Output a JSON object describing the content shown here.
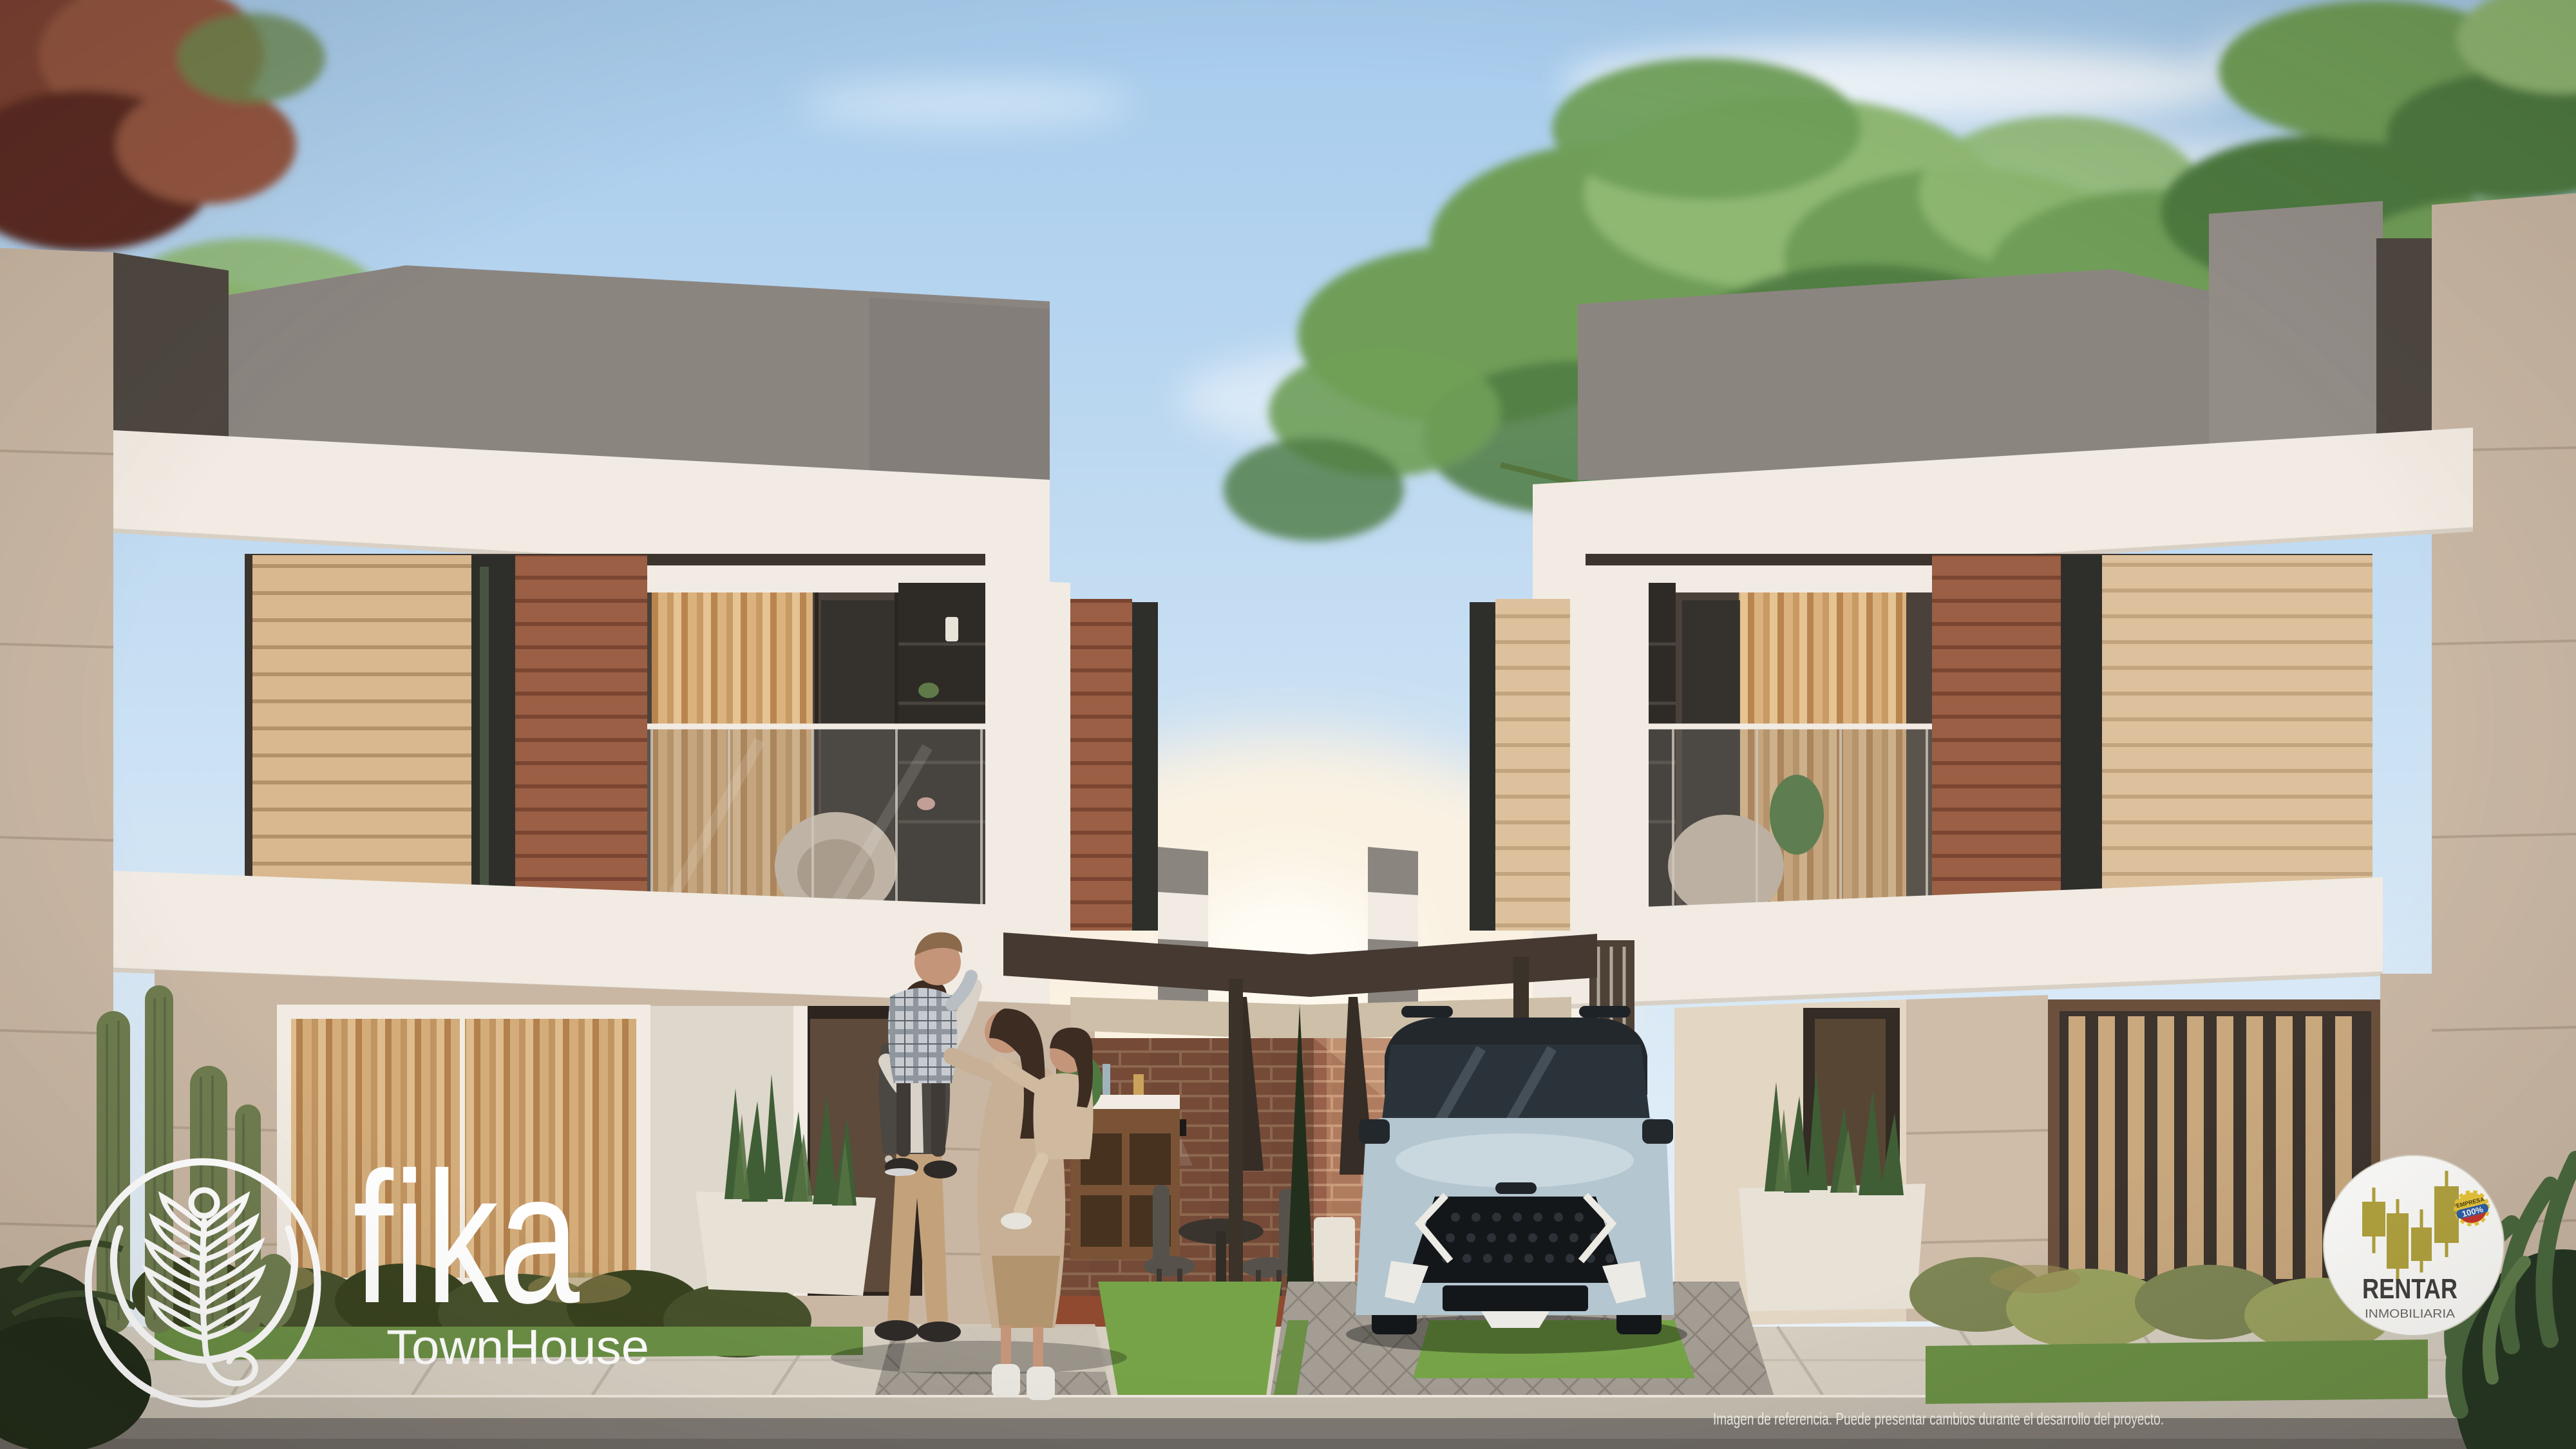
{
  "branding": {
    "fika": {
      "wordmark": "fika",
      "tagline": "TownHouse"
    },
    "rentar": {
      "wordmark": "RENTAR",
      "subtitle": "INMOBILIARIA",
      "badge_top": "EMPRESA",
      "badge_value": "100%"
    }
  },
  "footer": {
    "disclaimer": "Imagen de referencia. Puede presentar cambios durante el desarrollo del proyecto."
  },
  "colors": {
    "sky_top": "#a6cbec",
    "sky_mid": "#cde2f4",
    "sky_horizon": "#eef5fa",
    "sun_glow": "#fff3e0",
    "cloud": "#ffffff",
    "fol_red": "#7c4130",
    "fol_red2": "#93543f",
    "fol_red_dark": "#5a2c20",
    "fol_green": "#6f9e58",
    "fol_green_dark": "#4e7a41",
    "fol_green_light": "#8fb873",
    "concrete": "#8b8580",
    "concrete_dark": "#4e4741",
    "concrete_light": "#938d88",
    "band_white": "#f1ebe3",
    "band_shadow": "#d8d0c4",
    "stone": "#c9b7a4",
    "stone_seam": "#ac9a86",
    "stone_light": "#cfbdaa",
    "wood_light": "#d9b78f",
    "wood_light_gap": "#b5916a",
    "wood_dark": "#9a5f44",
    "wood_dark_gap": "#7a4531",
    "wood_pale": "#ddc19c",
    "wood_pale_gap": "#c2a47e",
    "glass_dark": "#2e2f2b",
    "interior_dark": "#3c342d",
    "interior_mid": "#4a423a",
    "curt1": "#b9854f",
    "curt2": "#dbb27e",
    "curt3": "#c89a64",
    "curt4": "#e6c392",
    "brick": "#96604a",
    "brick2": "#8f5a45",
    "brick_mortar": "#b98a6e",
    "pergola_dark": "#453931",
    "soffit": "#cdbfa8",
    "grass": "#6a8f45",
    "grass_bright": "#76a348",
    "bush_dark": "#38421f",
    "bush_mid": "#46512c",
    "bush_olive": "#7d8554",
    "bush_olive2": "#99a15f",
    "bush_gold": "#9a8d55",
    "cactus": "#6e7c4f",
    "cactus_dark": "#596745",
    "paver": "#a39d94",
    "paver_joint": "#8a847b",
    "patio_floor": "#8f4a30",
    "sidewalk": "#d6cfc2",
    "sidewalk_joint": "#b7b0a3",
    "curb": "#c3bcaf",
    "street": "#7d7872",
    "street_dark": "#6b6762",
    "car_body": "#b4c6d0",
    "car_body_light": "#cddbe2",
    "car_dark": "#23282d",
    "car_glass": "#2b333a",
    "car_trim": "#eceae4",
    "car_black": "#14171a",
    "skin": "#c59579",
    "hair_dark": "#3c2c22",
    "hair_brown": "#8a6a4a",
    "vest": "#4b4743",
    "shirt_light": "#d8d2c8",
    "pants_tan": "#c3a27b",
    "shoe_dark": "#2e2a28",
    "coat_beige": "#c7b095",
    "skirt_tan": "#b2946f",
    "boots_white": "#e9e6df",
    "plaid_base": "#c7cbd0",
    "plaid_line": "#8f969e",
    "wall_sunlit": "#e3d6c3",
    "door_wood": "#5d4a3a",
    "planter_white": "#e8e1d6",
    "logo_white": "#ffffff",
    "brand_gold": "#b2a33e",
    "brand_dark": "#403f3e",
    "brand_gray": "#6a6965",
    "badge_yellow": "#e9c63b",
    "badge_blue": "#2d5ea8",
    "badge_red": "#c8332f",
    "disclaimer_color": "#f5f2ec"
  }
}
